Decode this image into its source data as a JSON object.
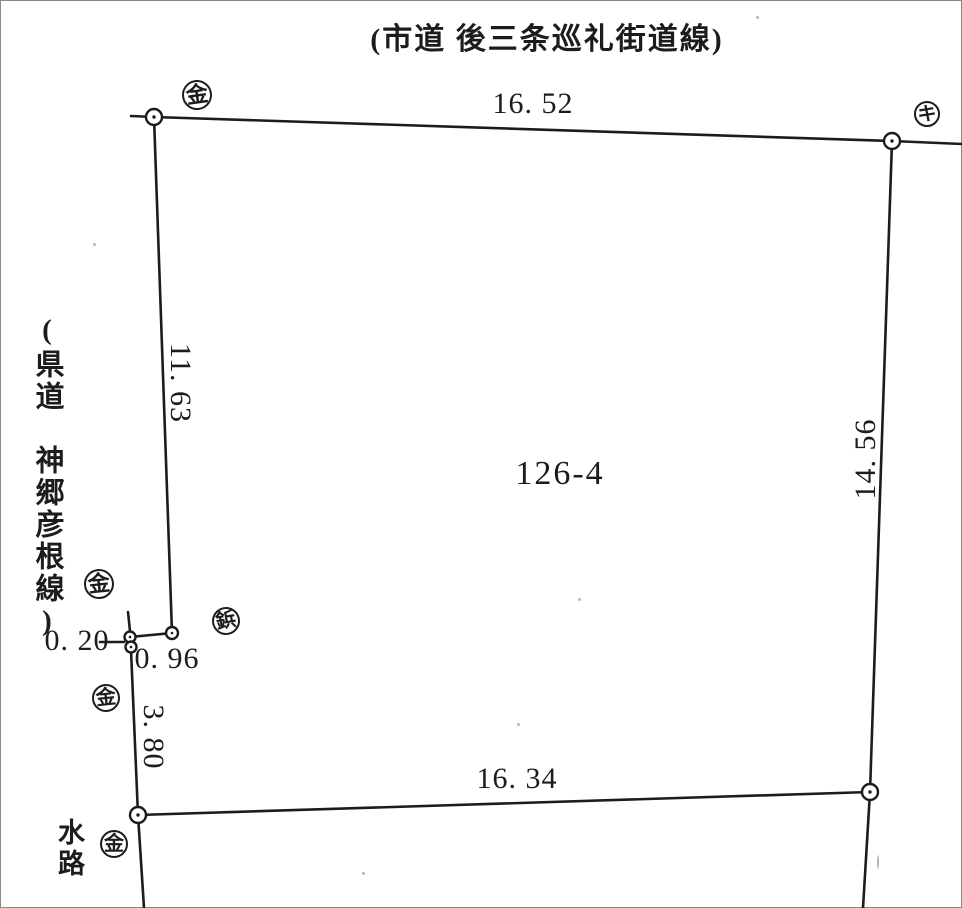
{
  "colors": {
    "ink": "#1c1c1c",
    "paper": "#ffffff",
    "noise": "#9a9a9a"
  },
  "labels": {
    "road_top": "(市道 後三条巡礼街道線)",
    "road_left": "(県道　神郷彦根線)",
    "waterway": "水路",
    "parcel_number": "126-4"
  },
  "diagram": {
    "lines": [
      {
        "name": "top-left-stub",
        "x1": 131,
        "y1": 116,
        "x2": 154,
        "y2": 117
      },
      {
        "name": "top-edge",
        "x1": 154,
        "y1": 117,
        "x2": 892,
        "y2": 141
      },
      {
        "name": "top-edge-extension",
        "x1": 892,
        "y1": 141,
        "x2": 962,
        "y2": 144
      },
      {
        "name": "left-edge",
        "x1": 154,
        "y1": 117,
        "x2": 172,
        "y2": 633
      },
      {
        "name": "jog-edge",
        "x1": 172,
        "y1": 633,
        "x2": 130,
        "y2": 637
      },
      {
        "name": "stub-above-jog",
        "x1": 128,
        "y1": 612,
        "x2": 130,
        "y2": 631
      },
      {
        "name": "leader-0-20",
        "x1": 100,
        "y1": 642,
        "x2": 124,
        "y2": 642
      },
      {
        "name": "lower-left-edge",
        "x1": 131,
        "y1": 650,
        "x2": 138,
        "y2": 815
      },
      {
        "name": "left-edge-extension",
        "x1": 138,
        "y1": 815,
        "x2": 144,
        "y2": 908
      },
      {
        "name": "bottom-edge",
        "x1": 138,
        "y1": 815,
        "x2": 870,
        "y2": 792
      },
      {
        "name": "right-edge-extension",
        "x1": 870,
        "y1": 792,
        "x2": 863,
        "y2": 908
      },
      {
        "name": "right-edge",
        "x1": 892,
        "y1": 141,
        "x2": 870,
        "y2": 792
      }
    ],
    "points": [
      {
        "name": "corner-top-left",
        "x": 154,
        "y": 117,
        "r": 8
      },
      {
        "name": "corner-top-right",
        "x": 892,
        "y": 141,
        "r": 8
      },
      {
        "name": "jog-point-right",
        "x": 172,
        "y": 633,
        "r": 6
      },
      {
        "name": "jog-point-upper",
        "x": 130,
        "y": 637,
        "r": 5.5
      },
      {
        "name": "jog-point-lower",
        "x": 131,
        "y": 647,
        "r": 5.5
      },
      {
        "name": "corner-bottom-left",
        "x": 138,
        "y": 815,
        "r": 8
      },
      {
        "name": "corner-bottom-right",
        "x": 870,
        "y": 792,
        "r": 8
      }
    ],
    "survey_markers": [
      {
        "name": "kin-marker-top-left",
        "symbol": "金",
        "x": 197,
        "y": 95,
        "r": 15,
        "tilt": -8
      },
      {
        "name": "ki-marker-top-right",
        "symbol": "キ",
        "x": 927,
        "y": 114,
        "r": 13,
        "tilt": 0
      },
      {
        "name": "kin-marker-mid-left",
        "symbol": "金",
        "x": 99,
        "y": 584,
        "r": 15,
        "tilt": -6
      },
      {
        "name": "byo-marker-jog",
        "symbol": "鋲",
        "x": 226,
        "y": 621,
        "r": 14,
        "tilt": -10
      },
      {
        "name": "kin-marker-lower-left",
        "symbol": "金",
        "x": 106,
        "y": 698,
        "r": 14,
        "tilt": -6
      },
      {
        "name": "kin-marker-bottom-left",
        "symbol": "金",
        "x": 114,
        "y": 844,
        "r": 14,
        "tilt": 0
      }
    ],
    "dimensions": [
      {
        "name": "dim-top",
        "value": "16. 52",
        "x": 533,
        "y": 104,
        "rotate": 0
      },
      {
        "name": "dim-left",
        "value": "11. 63",
        "x": 180,
        "y": 383,
        "rotate": 90
      },
      {
        "name": "dim-right",
        "value": "14. 56",
        "x": 866,
        "y": 459,
        "rotate": -90
      },
      {
        "name": "dim-bottom",
        "value": "16. 34",
        "x": 517,
        "y": 779,
        "rotate": 0
      },
      {
        "name": "dim-jog-horiz",
        "value": "0. 96",
        "x": 167,
        "y": 659,
        "rotate": 0
      },
      {
        "name": "dim-jog-tiny",
        "value": "0. 20",
        "x": 77,
        "y": 641,
        "rotate": 0
      },
      {
        "name": "dim-lower-left",
        "value": "3. 80",
        "x": 153,
        "y": 737,
        "rotate": 90
      }
    ],
    "noise_specks": [
      {
        "x": 756,
        "y": 16,
        "w": 3,
        "h": 3
      },
      {
        "x": 93,
        "y": 243,
        "w": 3,
        "h": 3
      },
      {
        "x": 578,
        "y": 598,
        "w": 3,
        "h": 3
      },
      {
        "x": 517,
        "y": 723,
        "w": 3,
        "h": 3
      },
      {
        "x": 362,
        "y": 872,
        "w": 3,
        "h": 3
      },
      {
        "x": 877,
        "y": 855,
        "w": 2,
        "h": 14
      }
    ]
  }
}
